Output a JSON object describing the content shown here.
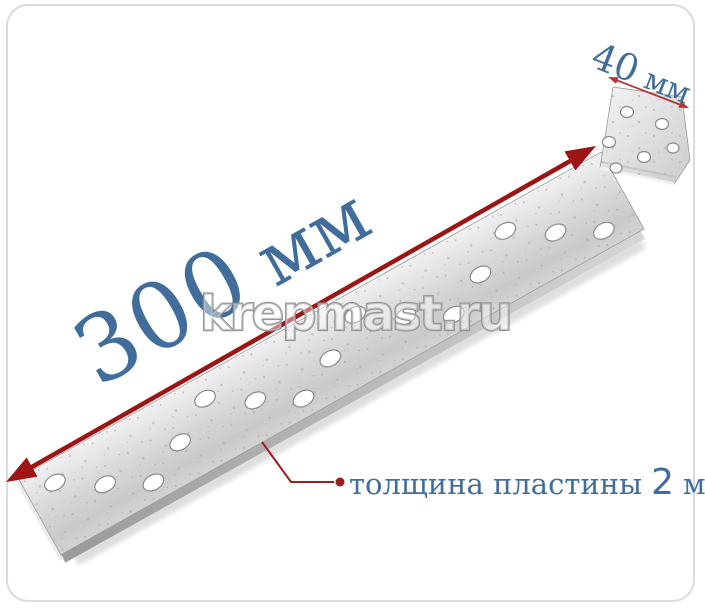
{
  "annotations": {
    "length": {
      "value": "300",
      "unit": "мм"
    },
    "width": {
      "value": "40",
      "unit": "мм"
    },
    "thickness": {
      "label": "толщина пластины",
      "value": "2",
      "unit": "мм"
    }
  },
  "watermark": {
    "text": "krepmast.ru"
  },
  "colors": {
    "label_blue": "#416d9c",
    "arrow_red": "#9c1414",
    "dim_line_red": "#b53434",
    "leader_red": "#9c1f1f",
    "frame_border": "#dbdbdb",
    "metal_light": "#f0f0f0",
    "metal_dark": "#c9c9c9"
  }
}
